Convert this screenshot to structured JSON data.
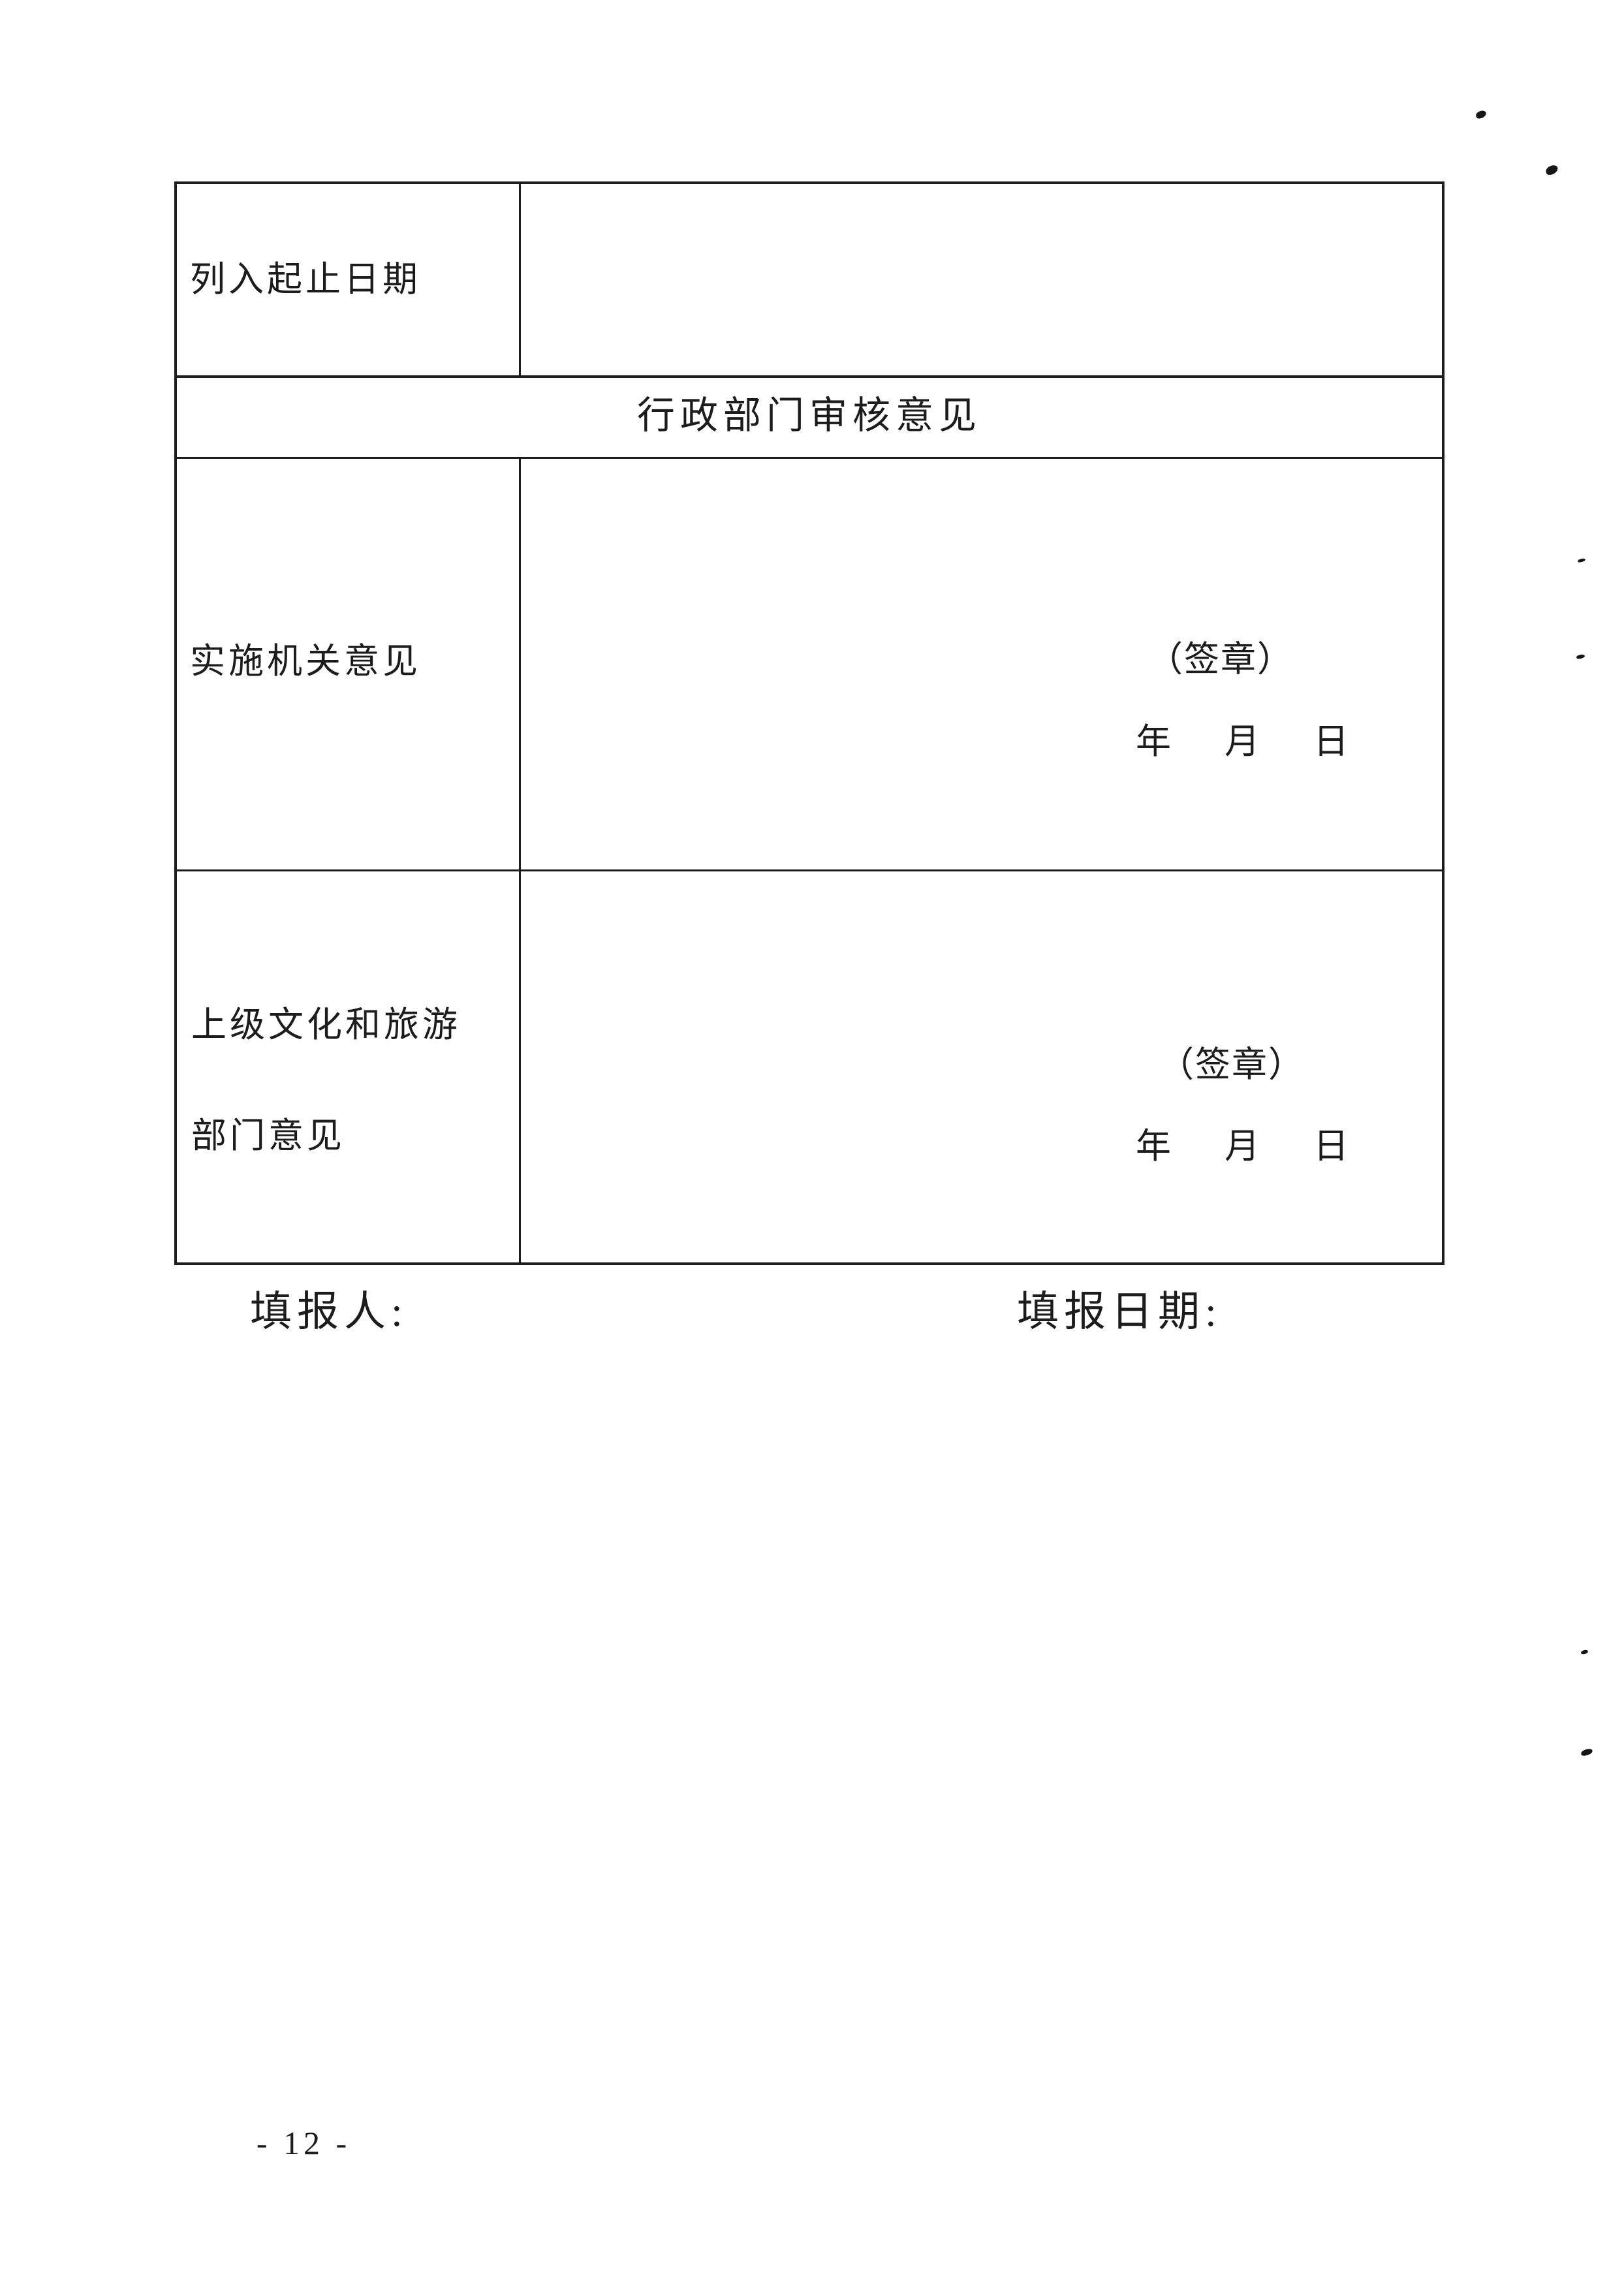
{
  "page": {
    "background_color": "#ffffff",
    "text_color": "#1c1c1c",
    "border_color": "#1c1c1c",
    "page_number": "- 12 -"
  },
  "table": {
    "listing_period_label": "列入起止日期",
    "section_header": "行政部门审核意见",
    "implementing_agency_label": "实施机关意见",
    "superior_dept_label_line1": "上级文化和旅游",
    "superior_dept_label_line2": "部门意见",
    "seal_label": "（签章）",
    "date_line": "年　月　日"
  },
  "footer": {
    "preparer_label": "填报人:",
    "fill_date_label": "填报日期:"
  }
}
